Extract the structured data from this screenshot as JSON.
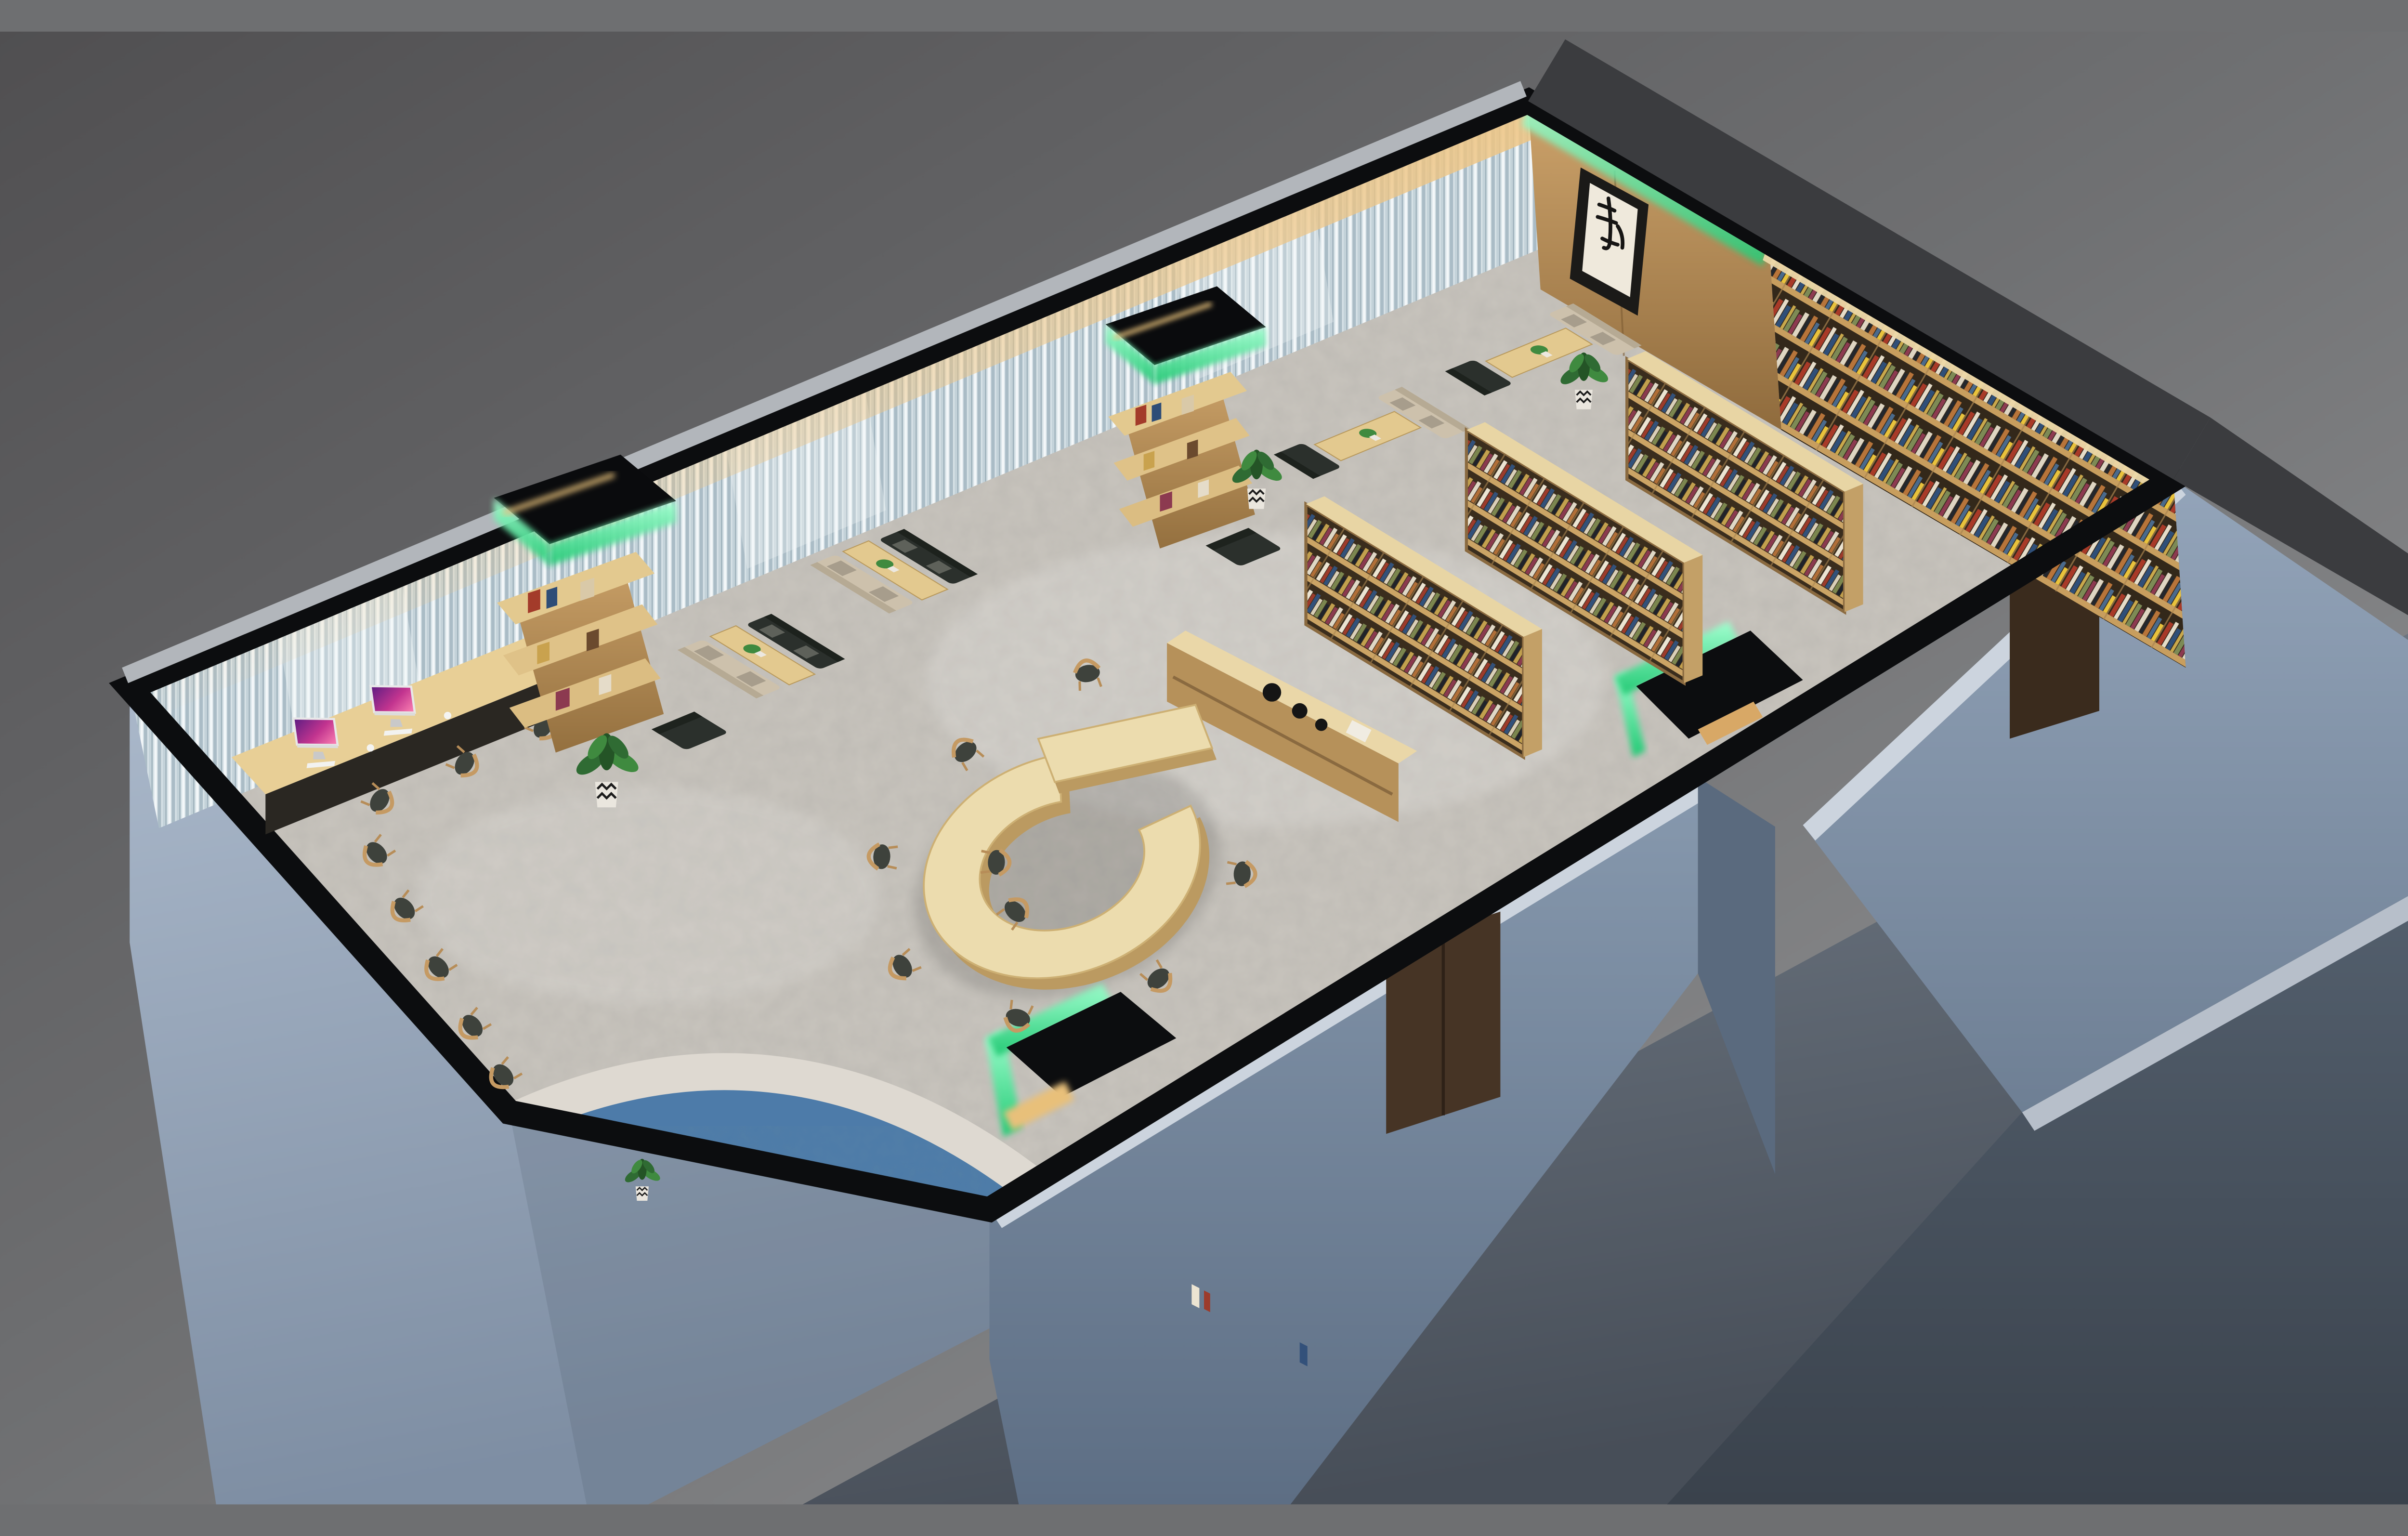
{
  "scene": {
    "type": "3d-interior-render",
    "room": "library reading lounge",
    "view": "isometric cutaway viewed from above"
  },
  "artwork": {
    "character": "静"
  },
  "labels": {
    "floor": "terrazzo floor with blue river carpet inlay",
    "river": "blue river carpet band",
    "curtain_wall": "window wall with striped sheer curtains and warm cove light",
    "wood_wall": "wood panelled wall with framed calligraphy",
    "bookshelf_wall": "full-height wall bookshelf filled with books and vases",
    "c_desk": "C-shaped reading table with wooden chairs",
    "computer_desk": "window-side computer desk with two iMacs",
    "tower_left": "column bookshelf tower with green LED crown",
    "tower_right": "column bookshelf tower with green LED crown",
    "booth": "lounge booth: wooden table, beige sofa and dark sofa",
    "standing_shelf": "freestanding double-sided bookshelf",
    "sideboard": "low display bookcase with black vases",
    "vestibule_south": "south entrance with green LED trim",
    "vestibule_east": "east entrance with green LED trim",
    "door_south": "exterior dark wooden double door",
    "door_east": "exterior dark wooden door",
    "chair_row": "row of wooden chairs along the wall",
    "plant": "potted plant in chevron vase",
    "exterior": "blue-grey exterior walls of the building shell"
  },
  "palette": {
    "bg_dark": "#545557",
    "bg_light": "#939496",
    "wall_black": "#0c0d0f",
    "wall_top_dark": "#3b3c3f",
    "edge_light": "#b2b6bb",
    "ext_light_cap": "#ccd4de",
    "ext_dark": "#5a6a7e",
    "floor": "#c9c5be",
    "river_blue": "#4d7ba9",
    "river_edge": "#ded9d1",
    "wood": "#c79e66",
    "wood_top": "#ecd9a9",
    "led_green": "#3fe08c",
    "warm_light": "#e8c07a",
    "sofa_dark": "#2b302c",
    "sofa_beige": "#cdc1ac",
    "chair_seat": "#3e423c",
    "chair_wood": "#c59a63",
    "door_brown": "#463425",
    "door_brown2": "#3a2b1d",
    "art_paper": "#efe9dc",
    "ink": "#1b1a18",
    "plant_green": "#2f6b33"
  }
}
